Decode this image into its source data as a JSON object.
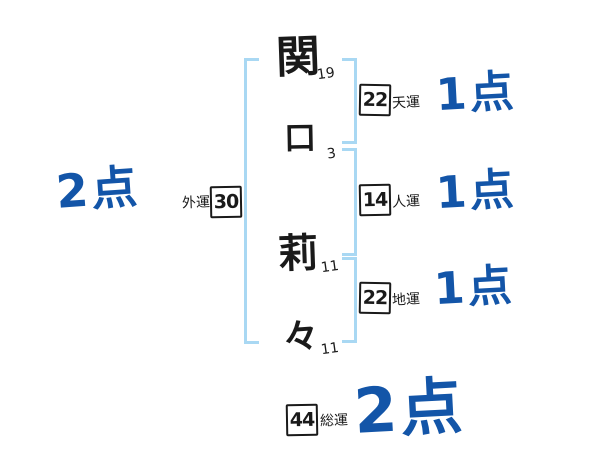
{
  "name": {
    "characters": [
      {
        "char": "関",
        "strokes": "19"
      },
      {
        "char": "口",
        "strokes": "3"
      },
      {
        "char": "莉",
        "strokes": "11"
      },
      {
        "char": "々",
        "strokes": "11"
      }
    ]
  },
  "fortunes": {
    "tenun": {
      "label": "天運",
      "value": "22",
      "score": "1点"
    },
    "jinun": {
      "label": "人運",
      "value": "14",
      "score": "1点"
    },
    "chiun": {
      "label": "地運",
      "value": "22",
      "score": "1点"
    },
    "gaiun": {
      "label": "外運",
      "value": "30",
      "score": "2点"
    },
    "soun": {
      "label": "総運",
      "value": "44",
      "score": "2点"
    }
  },
  "colors": {
    "score_blue": "#1355a8",
    "bracket_blue": "#a9d8f3",
    "ink": "#1a1a1a"
  }
}
